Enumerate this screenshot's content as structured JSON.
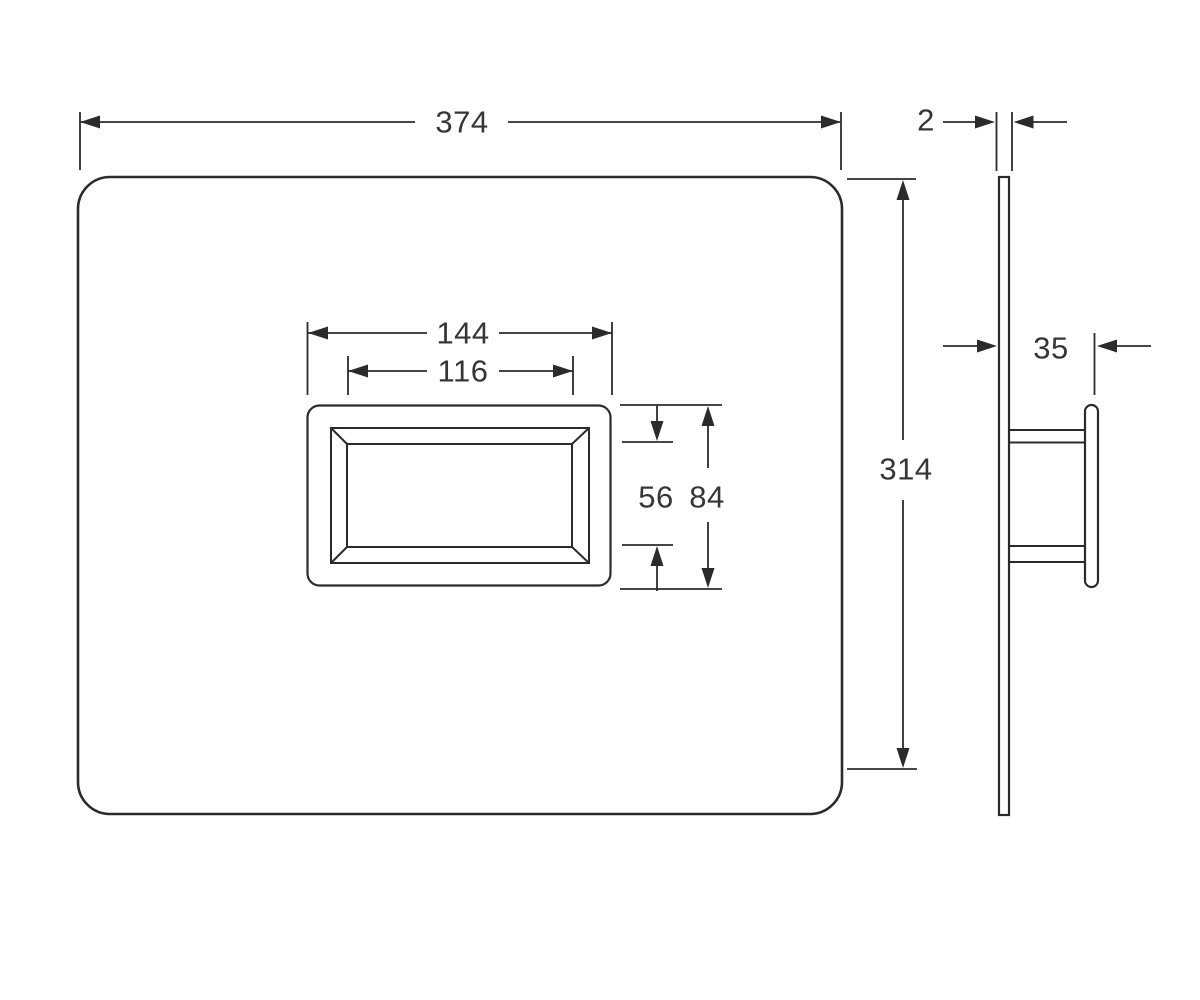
{
  "meta": {
    "type": "technical-dimension-drawing",
    "subject": "wall flush plate with rectangular actuator button, front view and side profile view",
    "units_shown": "mm (implied, unlabeled)"
  },
  "colors": {
    "line": "#2b2b2b",
    "text": "#363636",
    "background": "#ffffff"
  },
  "dimensions": {
    "plate_width": "374",
    "plate_thickness": "2",
    "plate_height": "314",
    "button_outer_width": "144",
    "button_inner_width": "116",
    "button_inner_height": "56",
    "button_outer_height": "84",
    "mount_depth": "35"
  }
}
